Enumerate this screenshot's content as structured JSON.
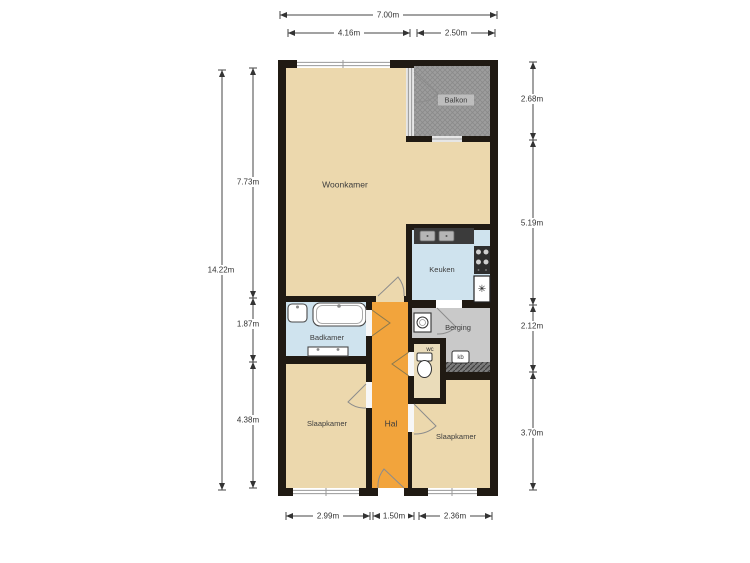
{
  "rooms": {
    "woonkamer": "Woonkamer",
    "balkon": "Balkon",
    "keuken": "Keuken",
    "badkamer": "Badkamer",
    "berging": "Berging",
    "wc": "wc",
    "kb": "kb",
    "hal": "Hal",
    "slaapkamer_left": "Slaapkamer",
    "slaapkamer_right": "Slaapkamer"
  },
  "dimensions": {
    "top_total": "7.00m",
    "top_left": "4.16m",
    "top_right": "2.50m",
    "left_total": "14.22m",
    "left_upper": "7.73m",
    "left_middle": "1.87m",
    "left_lower": "4.38m",
    "right_top": "2.68m",
    "right_upper": "5.19m",
    "right_middle": "2.12m",
    "right_lower": "3.70m",
    "bottom_left": "2.99m",
    "bottom_middle": "1.50m",
    "bottom_right": "2.36m"
  },
  "colors": {
    "wall": "#201a13",
    "floor_tan": "#ecd8ad",
    "floor_orange": "#f2a43c",
    "floor_blue": "#cfe3ee",
    "floor_gray": "#c9c9c9",
    "floor_wc": "#eadcba",
    "balcony_gray": "#9d9d9d",
    "counter_dark": "#3b3b3b"
  },
  "icons": {
    "snowflake": "✳"
  }
}
